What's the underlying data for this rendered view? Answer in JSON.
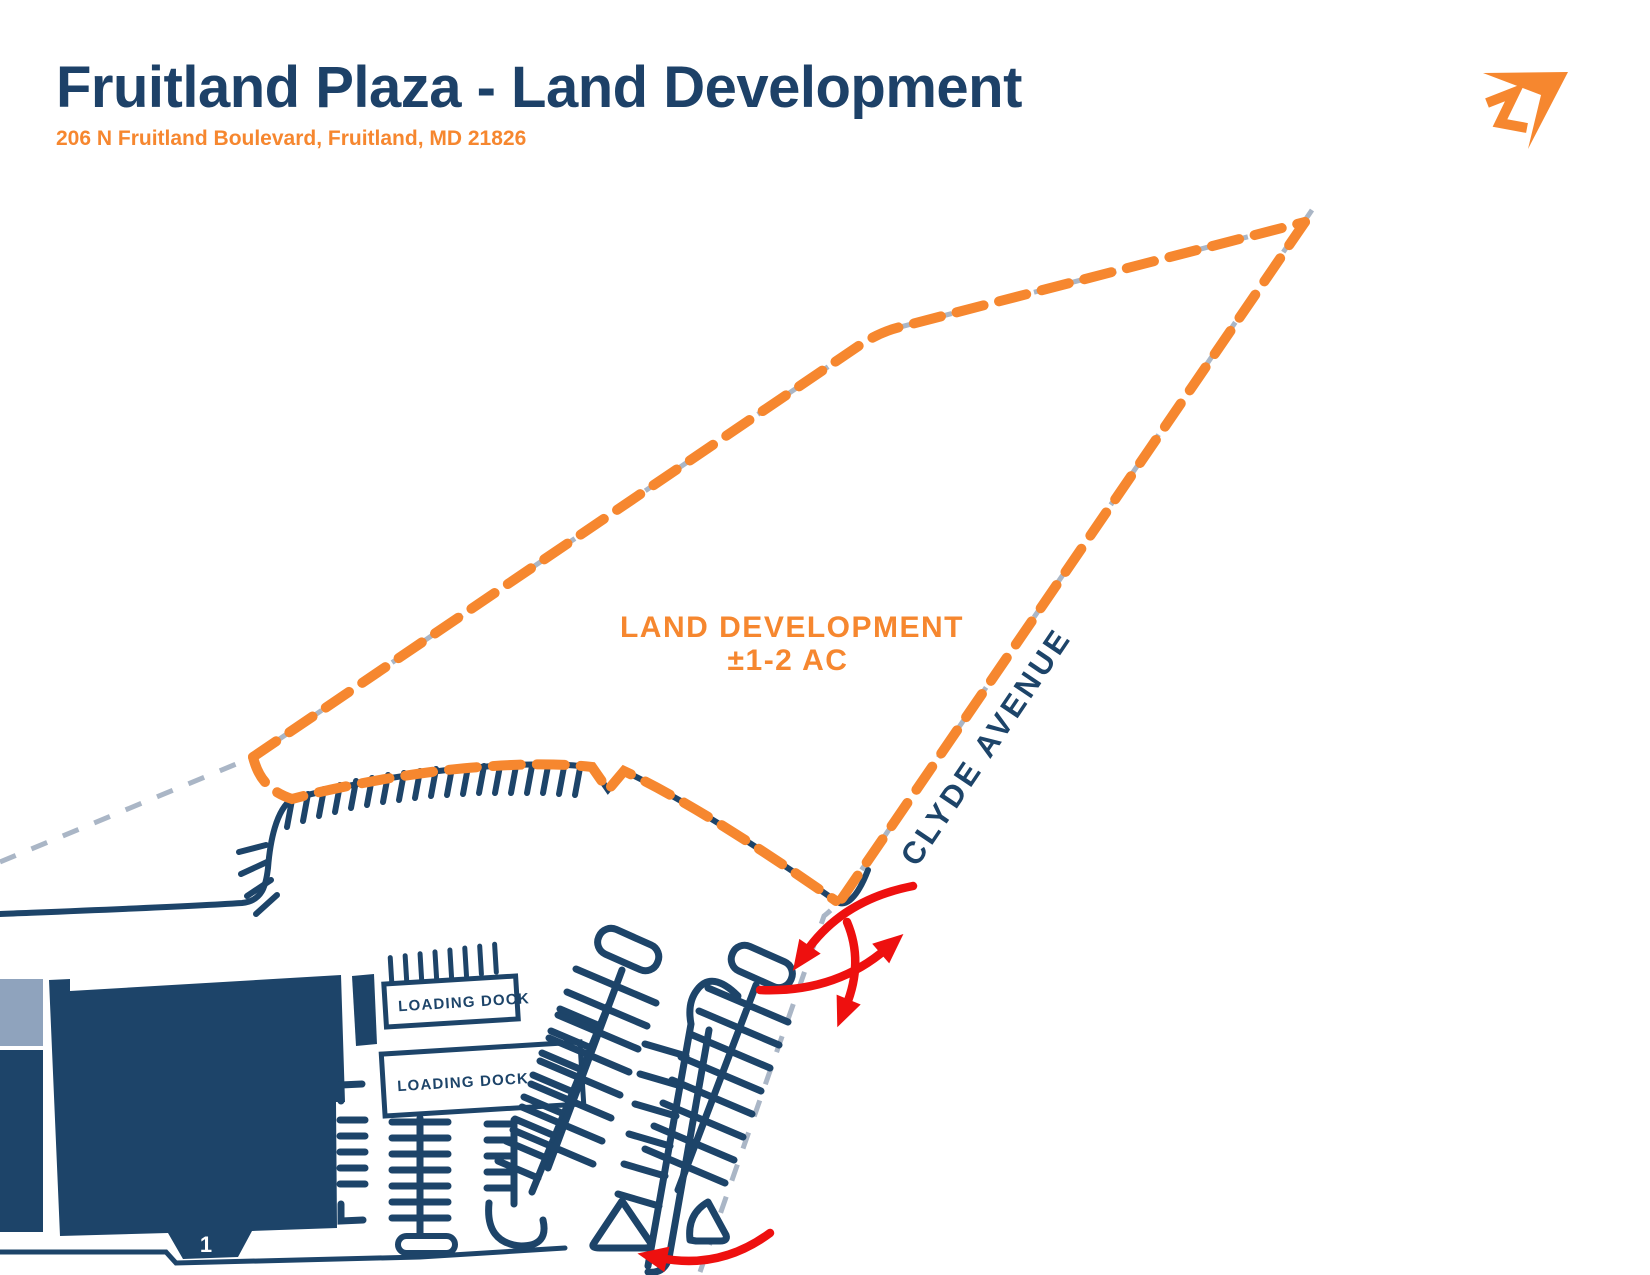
{
  "header": {
    "title": "Fruitland Plaza - Land Development",
    "subtitle": "206 N Fruitland Boulevard, Fruitland, MD 21826"
  },
  "logo": {
    "icon": "paper-plane-arrow-logo"
  },
  "site_plan": {
    "parcel": {
      "label_line1": "LAND DEVELOPMENT",
      "label_line2": "±1-2 AC"
    },
    "street": {
      "name": "CLYDE AVENUE"
    },
    "docks": [
      {
        "label": "LOADING DOCK"
      },
      {
        "label": "LOADING DOCK"
      }
    ],
    "building": {
      "unit_label": "1"
    },
    "colors": {
      "navy": "#1D4469",
      "title_navy": "#1D4168",
      "orange": "#F6872F",
      "gray_dash": "#AAB6C6",
      "building_light": "#8FA3BD",
      "red_arrow": "#EE100F"
    }
  }
}
